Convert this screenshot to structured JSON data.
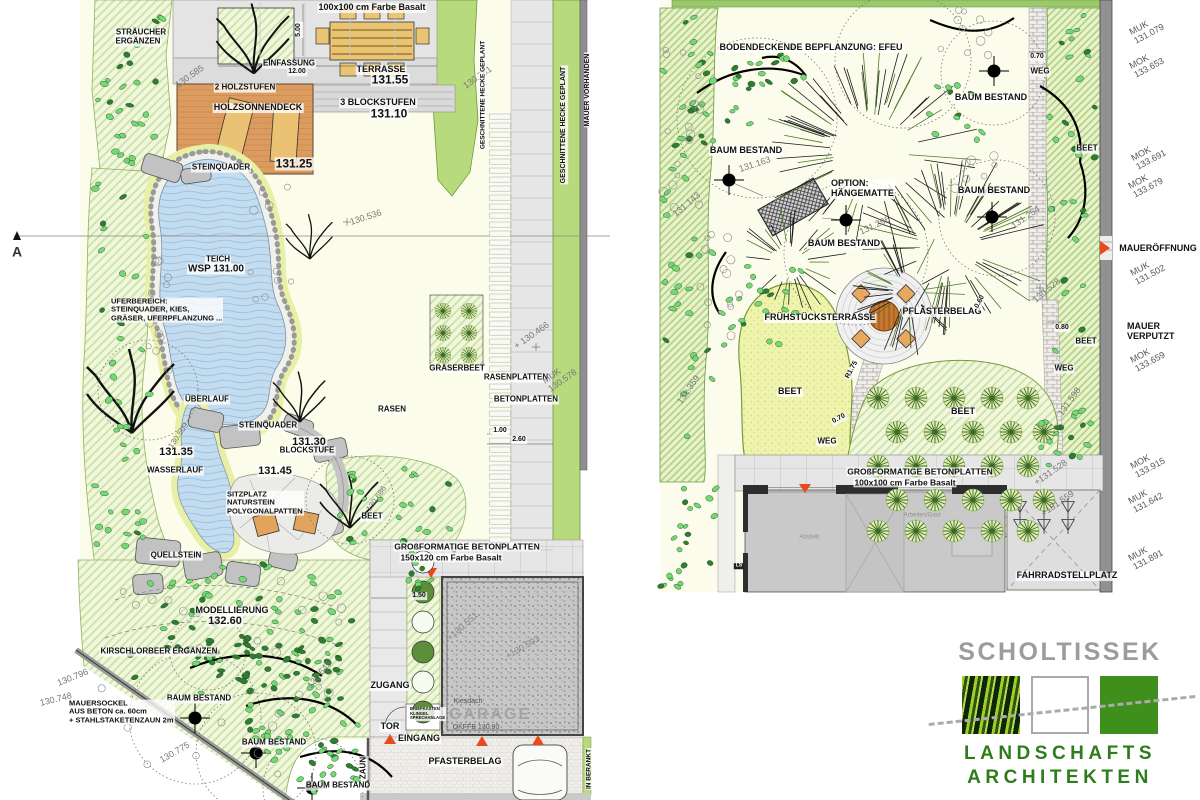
{
  "document": {
    "type": "landscape-architecture site plan",
    "sheets": [
      "garden plan left",
      "garden plan right"
    ]
  },
  "colors": {
    "bed_hatch": "#F1F7DE",
    "hedge_green": "#B6DA7C",
    "water_blue": "#C3DCEF",
    "wood_deck": "#DC9C60",
    "furniture_tan": "#E9C472",
    "accent_red": "#E8491D",
    "pavement_gray": "#E6E6E6",
    "wall_gray": "#8F8F8F",
    "logo_gray": "#9C9C9C",
    "logo_green": "#2E7D1B"
  },
  "logo": {
    "company": "SCHOLTISSEK",
    "line1": "LANDSCHAFTS",
    "line2": "ARCHITEKTEN"
  },
  "left_plan": {
    "labels": [
      {
        "t": "100x100 cm Farbe Basalt",
        "x": 372,
        "y": 8,
        "s": 9,
        "w": "b"
      },
      {
        "t": "5.00",
        "x": 299,
        "y": 30,
        "s": 7,
        "w": "b",
        "r": -90
      },
      {
        "t": "STRÄUCHER",
        "x": 141,
        "y": 33,
        "s": 8,
        "w": "b"
      },
      {
        "t": "ERGÄNZEN",
        "x": 138,
        "y": 42,
        "s": 8,
        "w": "b"
      },
      {
        "t": "EINFASSUNG",
        "x": 289,
        "y": 64,
        "s": 8,
        "w": "b"
      },
      {
        "t": "12.00",
        "x": 297,
        "y": 72,
        "s": 7,
        "w": "b"
      },
      {
        "t": "TERRASSE",
        "x": 381,
        "y": 70,
        "s": 9,
        "w": "b"
      },
      {
        "t": "131.55",
        "x": 390,
        "y": 80,
        "s": 12,
        "w": "b"
      },
      {
        "t": "2 HOLZSTUFEN",
        "x": 245,
        "y": 88,
        "s": 8,
        "w": "b"
      },
      {
        "t": "HOLZSONNENDECK",
        "x": 258,
        "y": 108,
        "s": 9,
        "w": "b"
      },
      {
        "t": "3 BLOCKSTUFEN",
        "x": 378,
        "y": 103,
        "s": 9,
        "w": "b"
      },
      {
        "t": "131.10",
        "x": 389,
        "y": 114,
        "s": 12,
        "w": "b"
      },
      {
        "t": "STEINQUADER",
        "x": 221,
        "y": 168,
        "s": 8,
        "w": "b"
      },
      {
        "t": "131.25",
        "x": 294,
        "y": 164,
        "s": 12,
        "w": "b"
      },
      {
        "t": "130.585",
        "x": 190,
        "y": 77,
        "s": 9,
        "r": -35,
        "c": "#777777"
      },
      {
        "t": "130.781",
        "x": 478,
        "y": 78,
        "s": 9,
        "r": -35,
        "c": "#777777"
      },
      {
        "t": "130.536",
        "x": 366,
        "y": 218,
        "s": 9,
        "r": -18,
        "c": "#777777"
      },
      {
        "t": "TEICH",
        "x": 218,
        "y": 260,
        "s": 8,
        "w": "b"
      },
      {
        "t": "WSP 131.00",
        "x": 216,
        "y": 269,
        "s": 10,
        "w": "b"
      },
      {
        "t": "UFERBEREICH:\nSTEINQUADER, KIES,\nGRÄSER, UFERPFLANZUNG ...",
        "x": 110,
        "y": 310,
        "s": 7.5,
        "w": "b",
        "a": "l"
      },
      {
        "t": "ÜBERLAUF",
        "x": 207,
        "y": 400,
        "s": 8,
        "w": "b"
      },
      {
        "t": "STEINQUADER",
        "x": 268,
        "y": 426,
        "s": 8,
        "w": "b"
      },
      {
        "t": "131.30",
        "x": 309,
        "y": 442,
        "s": 11,
        "w": "b"
      },
      {
        "t": "BLOCKSTUFE",
        "x": 307,
        "y": 451,
        "s": 8,
        "w": "b"
      },
      {
        "t": "131.45",
        "x": 275,
        "y": 471,
        "s": 11,
        "w": "b"
      },
      {
        "t": "131.35",
        "x": 176,
        "y": 452,
        "s": 11,
        "w": "b"
      },
      {
        "t": "WASSERLAUF",
        "x": 175,
        "y": 471,
        "s": 8,
        "w": "b"
      },
      {
        "t": "130.509",
        "x": 179,
        "y": 436,
        "s": 8,
        "r": -55,
        "c": "#777777"
      },
      {
        "t": "SITZPLATZ\nNATURSTEIN\nPOLYGONALPATTEN",
        "x": 226,
        "y": 503,
        "s": 7.5,
        "w": "b",
        "a": "l"
      },
      {
        "t": "BEET",
        "x": 372,
        "y": 517,
        "s": 8,
        "w": "b"
      },
      {
        "t": "130.686",
        "x": 377,
        "y": 499,
        "s": 8,
        "r": -55,
        "c": "#777777"
      },
      {
        "t": "QUELLSTEIN",
        "x": 176,
        "y": 556,
        "s": 8,
        "w": "b"
      },
      {
        "t": "MODELLIERUNG",
        "x": 232,
        "y": 611,
        "s": 9,
        "w": "b"
      },
      {
        "t": "132.60",
        "x": 225,
        "y": 621,
        "s": 11,
        "w": "b"
      },
      {
        "t": "KIRSCHLORBEER ERGÄNZEN",
        "x": 159,
        "y": 652,
        "s": 8,
        "w": "b"
      },
      {
        "t": "GRÄSERBEET",
        "x": 457,
        "y": 369,
        "s": 8,
        "w": "b"
      },
      {
        "t": "RASENPLATTEN",
        "x": 516,
        "y": 378,
        "s": 8,
        "w": "b"
      },
      {
        "t": "BETONPLATTEN",
        "x": 526,
        "y": 400,
        "s": 8,
        "w": "b"
      },
      {
        "t": "RASEN",
        "x": 392,
        "y": 410,
        "s": 8,
        "w": "b"
      },
      {
        "t": "1.00",
        "x": 500,
        "y": 431,
        "s": 7,
        "w": "b"
      },
      {
        "t": "2.60",
        "x": 519,
        "y": 440,
        "s": 7,
        "w": "b"
      },
      {
        "t": "+ 130.466",
        "x": 532,
        "y": 336,
        "s": 9,
        "r": -35,
        "c": "#777777"
      },
      {
        "t": "MUK\n130.578",
        "x": 560,
        "y": 377,
        "s": 9,
        "r": -35,
        "c": "#777777"
      },
      {
        "t": "GESCHNITTENE HECKE GEPLANT",
        "x": 483,
        "y": 95,
        "s": 6.5,
        "w": "b",
        "r": -90
      },
      {
        "t": "GESCHNITTENE HECKE GEPLANT",
        "x": 564,
        "y": 125,
        "s": 7,
        "w": "b",
        "r": -90
      },
      {
        "t": "MAUER VORHANDEN",
        "x": 588,
        "y": 90,
        "s": 7,
        "w": "b",
        "r": -90
      },
      {
        "t": "GROßFORMATIGE BETONPLATTEN",
        "x": 467,
        "y": 547,
        "s": 8.5,
        "w": "b"
      },
      {
        "t": "150x120 cm Farbe Basalt",
        "x": 451,
        "y": 558,
        "s": 8.5,
        "w": "b"
      },
      {
        "t": "1.50",
        "x": 419,
        "y": 596,
        "s": 7,
        "w": "b"
      },
      {
        "t": "+130.551",
        "x": 463,
        "y": 627,
        "s": 9,
        "r": -42,
        "c": "#888888"
      },
      {
        "t": "+130.503",
        "x": 523,
        "y": 648,
        "s": 9,
        "r": -30,
        "c": "#888888"
      },
      {
        "t": "Kiesdach",
        "x": 468,
        "y": 702,
        "s": 7,
        "c": "#555555"
      },
      {
        "t": "GARAGE",
        "x": 490,
        "y": 715,
        "s": 16,
        "w": "b",
        "c": "#A3A3A3",
        "ls": 2
      },
      {
        "t": "OKFFB 130.90",
        "x": 476,
        "y": 728,
        "s": 7,
        "c": "#555555"
      },
      {
        "t": "ZUGANG",
        "x": 390,
        "y": 686,
        "s": 9,
        "w": "b"
      },
      {
        "t": "TOR",
        "x": 390,
        "y": 727,
        "s": 9,
        "w": "b"
      },
      {
        "t": "BRIEFKASTEN\nKLINGEL\nSPRECHANLAGE",
        "x": 409,
        "y": 714,
        "s": 4.2,
        "w": "b",
        "a": "l"
      },
      {
        "t": "EINGANG",
        "x": 419,
        "y": 739,
        "s": 9,
        "w": "b"
      },
      {
        "t": "PFASTERBELAG",
        "x": 465,
        "y": 762,
        "s": 9,
        "w": "b"
      },
      {
        "t": "ZAUN",
        "x": 364,
        "y": 768,
        "s": 8,
        "w": "b",
        "r": -90
      },
      {
        "t": "IN BERANKT",
        "x": 589,
        "y": 769,
        "s": 6.5,
        "w": "b",
        "r": -90
      },
      {
        "t": "BAUM BESTAND",
        "x": 199,
        "y": 699,
        "s": 8,
        "w": "b"
      },
      {
        "t": "BAUM BESTAND",
        "x": 274,
        "y": 743,
        "s": 8,
        "w": "b"
      },
      {
        "t": "BAUM BESTAND",
        "x": 338,
        "y": 786,
        "s": 8,
        "w": "b"
      },
      {
        "t": "MAUERSOCKEL\nAUS BETON ca. 60cm\n+ STAHLSTAKETENZAUN 2m",
        "x": 68,
        "y": 712,
        "s": 7.5,
        "w": "b",
        "a": "l"
      },
      {
        "t": "130.796",
        "x": 73,
        "y": 678,
        "s": 9,
        "r": -22,
        "c": "#777777"
      },
      {
        "t": "130.748",
        "x": 56,
        "y": 700,
        "s": 9,
        "r": -14,
        "c": "#777777"
      },
      {
        "t": "130.775",
        "x": 175,
        "y": 753,
        "s": 9,
        "r": -30,
        "c": "#777777"
      },
      {
        "t": "130.645",
        "x": 320,
        "y": 675,
        "s": 9,
        "r": -50,
        "c": "#777777"
      },
      {
        "t": "A",
        "x": 17,
        "y": 252,
        "s": 14,
        "w": "b",
        "c": "#333333",
        "n": "section-marker-a"
      }
    ]
  },
  "right_plan": {
    "labels": [
      {
        "t": "BODENDECKENDE BEPFLANZUNG: EFEU",
        "x": 811,
        "y": 48,
        "s": 9,
        "w": "b"
      },
      {
        "t": "BAUM BESTAND",
        "x": 746,
        "y": 151,
        "s": 9,
        "w": "b"
      },
      {
        "t": "131.163",
        "x": 755,
        "y": 165,
        "s": 9,
        "r": -18,
        "c": "#777777"
      },
      {
        "t": "131.143",
        "x": 687,
        "y": 205,
        "s": 9,
        "r": -40,
        "c": "#777777"
      },
      {
        "t": "OPTION:\nHÄNGEMATTE",
        "x": 830,
        "y": 189,
        "s": 9,
        "w": "b",
        "a": "l"
      },
      {
        "t": "BAUM BESTAND",
        "x": 844,
        "y": 244,
        "s": 9,
        "w": "b"
      },
      {
        "t": "131.296",
        "x": 875,
        "y": 226,
        "s": 9,
        "r": -25,
        "c": "#777777"
      },
      {
        "t": "BAUM BESTAND",
        "x": 991,
        "y": 98,
        "s": 9,
        "w": "b"
      },
      {
        "t": "BAUM BESTAND",
        "x": 994,
        "y": 191,
        "s": 9,
        "w": "b"
      },
      {
        "t": "131.254",
        "x": 1026,
        "y": 218,
        "s": 9,
        "r": -35,
        "c": "#777777"
      },
      {
        "t": "0.70",
        "x": 1037,
        "y": 57,
        "s": 7,
        "w": "b"
      },
      {
        "t": "WEG",
        "x": 1040,
        "y": 72,
        "s": 8,
        "w": "b"
      },
      {
        "t": "BEET",
        "x": 1087,
        "y": 149,
        "s": 8,
        "w": "b"
      },
      {
        "t": "BEET",
        "x": 1086,
        "y": 342,
        "s": 8,
        "w": "b"
      },
      {
        "t": "FRÜHSTÜCKSTERRASSE",
        "x": 820,
        "y": 318,
        "s": 9,
        "w": "b"
      },
      {
        "t": "PFLASTERBELAG",
        "x": 942,
        "y": 312,
        "s": 9,
        "w": "b"
      },
      {
        "t": "BEET",
        "x": 790,
        "y": 392,
        "s": 9,
        "w": "b"
      },
      {
        "t": "BEET",
        "x": 963,
        "y": 412,
        "s": 9,
        "w": "b"
      },
      {
        "t": "R1.75",
        "x": 852,
        "y": 370,
        "s": 7,
        "w": "b",
        "r": -62
      },
      {
        "t": "0.70",
        "x": 839,
        "y": 419,
        "s": 7,
        "w": "b",
        "r": -28
      },
      {
        "t": "WEG",
        "x": 827,
        "y": 442,
        "s": 8,
        "w": "b"
      },
      {
        "t": "0.60",
        "x": 980,
        "y": 302,
        "s": 7,
        "w": "b",
        "r": -62
      },
      {
        "t": "0.80",
        "x": 1062,
        "y": 328,
        "s": 7,
        "w": "b"
      },
      {
        "t": "WEG",
        "x": 1064,
        "y": 369,
        "s": 8,
        "w": "b"
      },
      {
        "t": "131.359",
        "x": 689,
        "y": 390,
        "s": 9,
        "r": -55,
        "c": "#777777"
      },
      {
        "t": "130.528",
        "x": 1047,
        "y": 291,
        "s": 9,
        "r": -40,
        "c": "#777777"
      },
      {
        "t": "131.598",
        "x": 1070,
        "y": 402,
        "s": 9,
        "r": -55,
        "c": "#777777"
      },
      {
        "t": "+131.528",
        "x": 1051,
        "y": 473,
        "s": 9,
        "r": -35,
        "c": "#777777"
      },
      {
        "t": "+131.559",
        "x": 1058,
        "y": 504,
        "s": 9,
        "r": -35,
        "c": "#777777"
      },
      {
        "t": "GROßFORMATIGE BETONPLATTEN",
        "x": 920,
        "y": 472,
        "s": 8.5,
        "w": "b"
      },
      {
        "t": "100x100 cm Farbe Basalt",
        "x": 905,
        "y": 483,
        "s": 8.5,
        "w": "b"
      },
      {
        "t": "FAHRRADSTELLPLATZ",
        "x": 1067,
        "y": 576,
        "s": 9,
        "w": "b"
      },
      {
        "t": "Abstellr.",
        "x": 810,
        "y": 538,
        "s": 6,
        "c": "#909090"
      },
      {
        "t": "Arbeiten/Gast",
        "x": 922,
        "y": 516,
        "s": 6,
        "c": "#909090"
      },
      {
        "t": "LS",
        "x": 739,
        "y": 566,
        "s": 5,
        "w": "b",
        "c": "#FFFFFF",
        "bg": "#222222"
      },
      {
        "t": "MAUERÖFFNUNG",
        "x": 1158,
        "y": 249,
        "s": 9,
        "w": "b"
      },
      {
        "t": "MAUER\nVERPUTZT",
        "x": 1126,
        "y": 332,
        "s": 9,
        "w": "b",
        "a": "l"
      }
    ]
  },
  "margin_labels": [
    {
      "t": "MUK\n131.079",
      "x": 1147,
      "y": 30,
      "s": 9,
      "r": -28,
      "c": "#555555"
    },
    {
      "t": "MOK\n133.653",
      "x": 1147,
      "y": 64,
      "s": 9,
      "r": -28,
      "c": "#555555"
    },
    {
      "t": "MOK\n133.691",
      "x": 1149,
      "y": 156,
      "s": 9,
      "r": -28,
      "c": "#555555"
    },
    {
      "t": "MOK\n133.679",
      "x": 1146,
      "y": 184,
      "s": 9,
      "r": -28,
      "c": "#555555"
    },
    {
      "t": "MUK\n131.502",
      "x": 1148,
      "y": 271,
      "s": 9,
      "r": -28,
      "c": "#555555"
    },
    {
      "t": "MOK\n133.659",
      "x": 1148,
      "y": 358,
      "s": 9,
      "r": -28,
      "c": "#555555"
    },
    {
      "t": "MOK\n133.915",
      "x": 1148,
      "y": 464,
      "s": 9,
      "r": -28,
      "c": "#555555"
    },
    {
      "t": "MUK\n131.642",
      "x": 1146,
      "y": 499,
      "s": 9,
      "r": -28,
      "c": "#555555"
    },
    {
      "t": "MUK\n131.891",
      "x": 1146,
      "y": 556,
      "s": 9,
      "r": -28,
      "c": "#555555"
    }
  ]
}
